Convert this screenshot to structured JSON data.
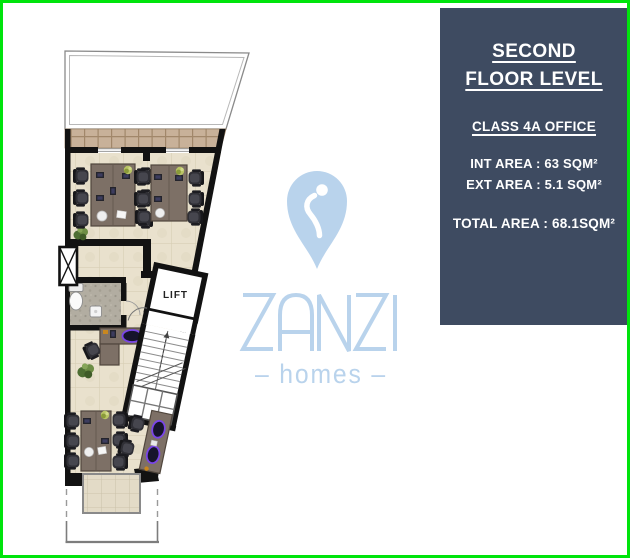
{
  "panel": {
    "title_line1": "SECOND",
    "title_line2": "FLOOR LEVEL",
    "class_label": "CLASS 4A OFFICE",
    "int_area_label": "INT AREA : 63 SQM²",
    "ext_area_label": "EXT AREA : 5.1 SQM²",
    "total_area_label": "TOTAL AREA : 68.1SQM²"
  },
  "logo": {
    "brand": "ZANZI",
    "tagline": "– homes –"
  },
  "floor_plan": {
    "lift_label": "LIFT"
  },
  "colors": {
    "border_green": "#00e40c",
    "panel_bg": "#3e4b61",
    "panel_text": "#ffffff",
    "logo_blue": "#b9d3ec",
    "wall_black": "#121212",
    "floor_beige": "#e9e1cd",
    "terrace_tan": "#c8b199",
    "desk_brown": "#7d7066",
    "accent_purple": "#7a45e8"
  }
}
